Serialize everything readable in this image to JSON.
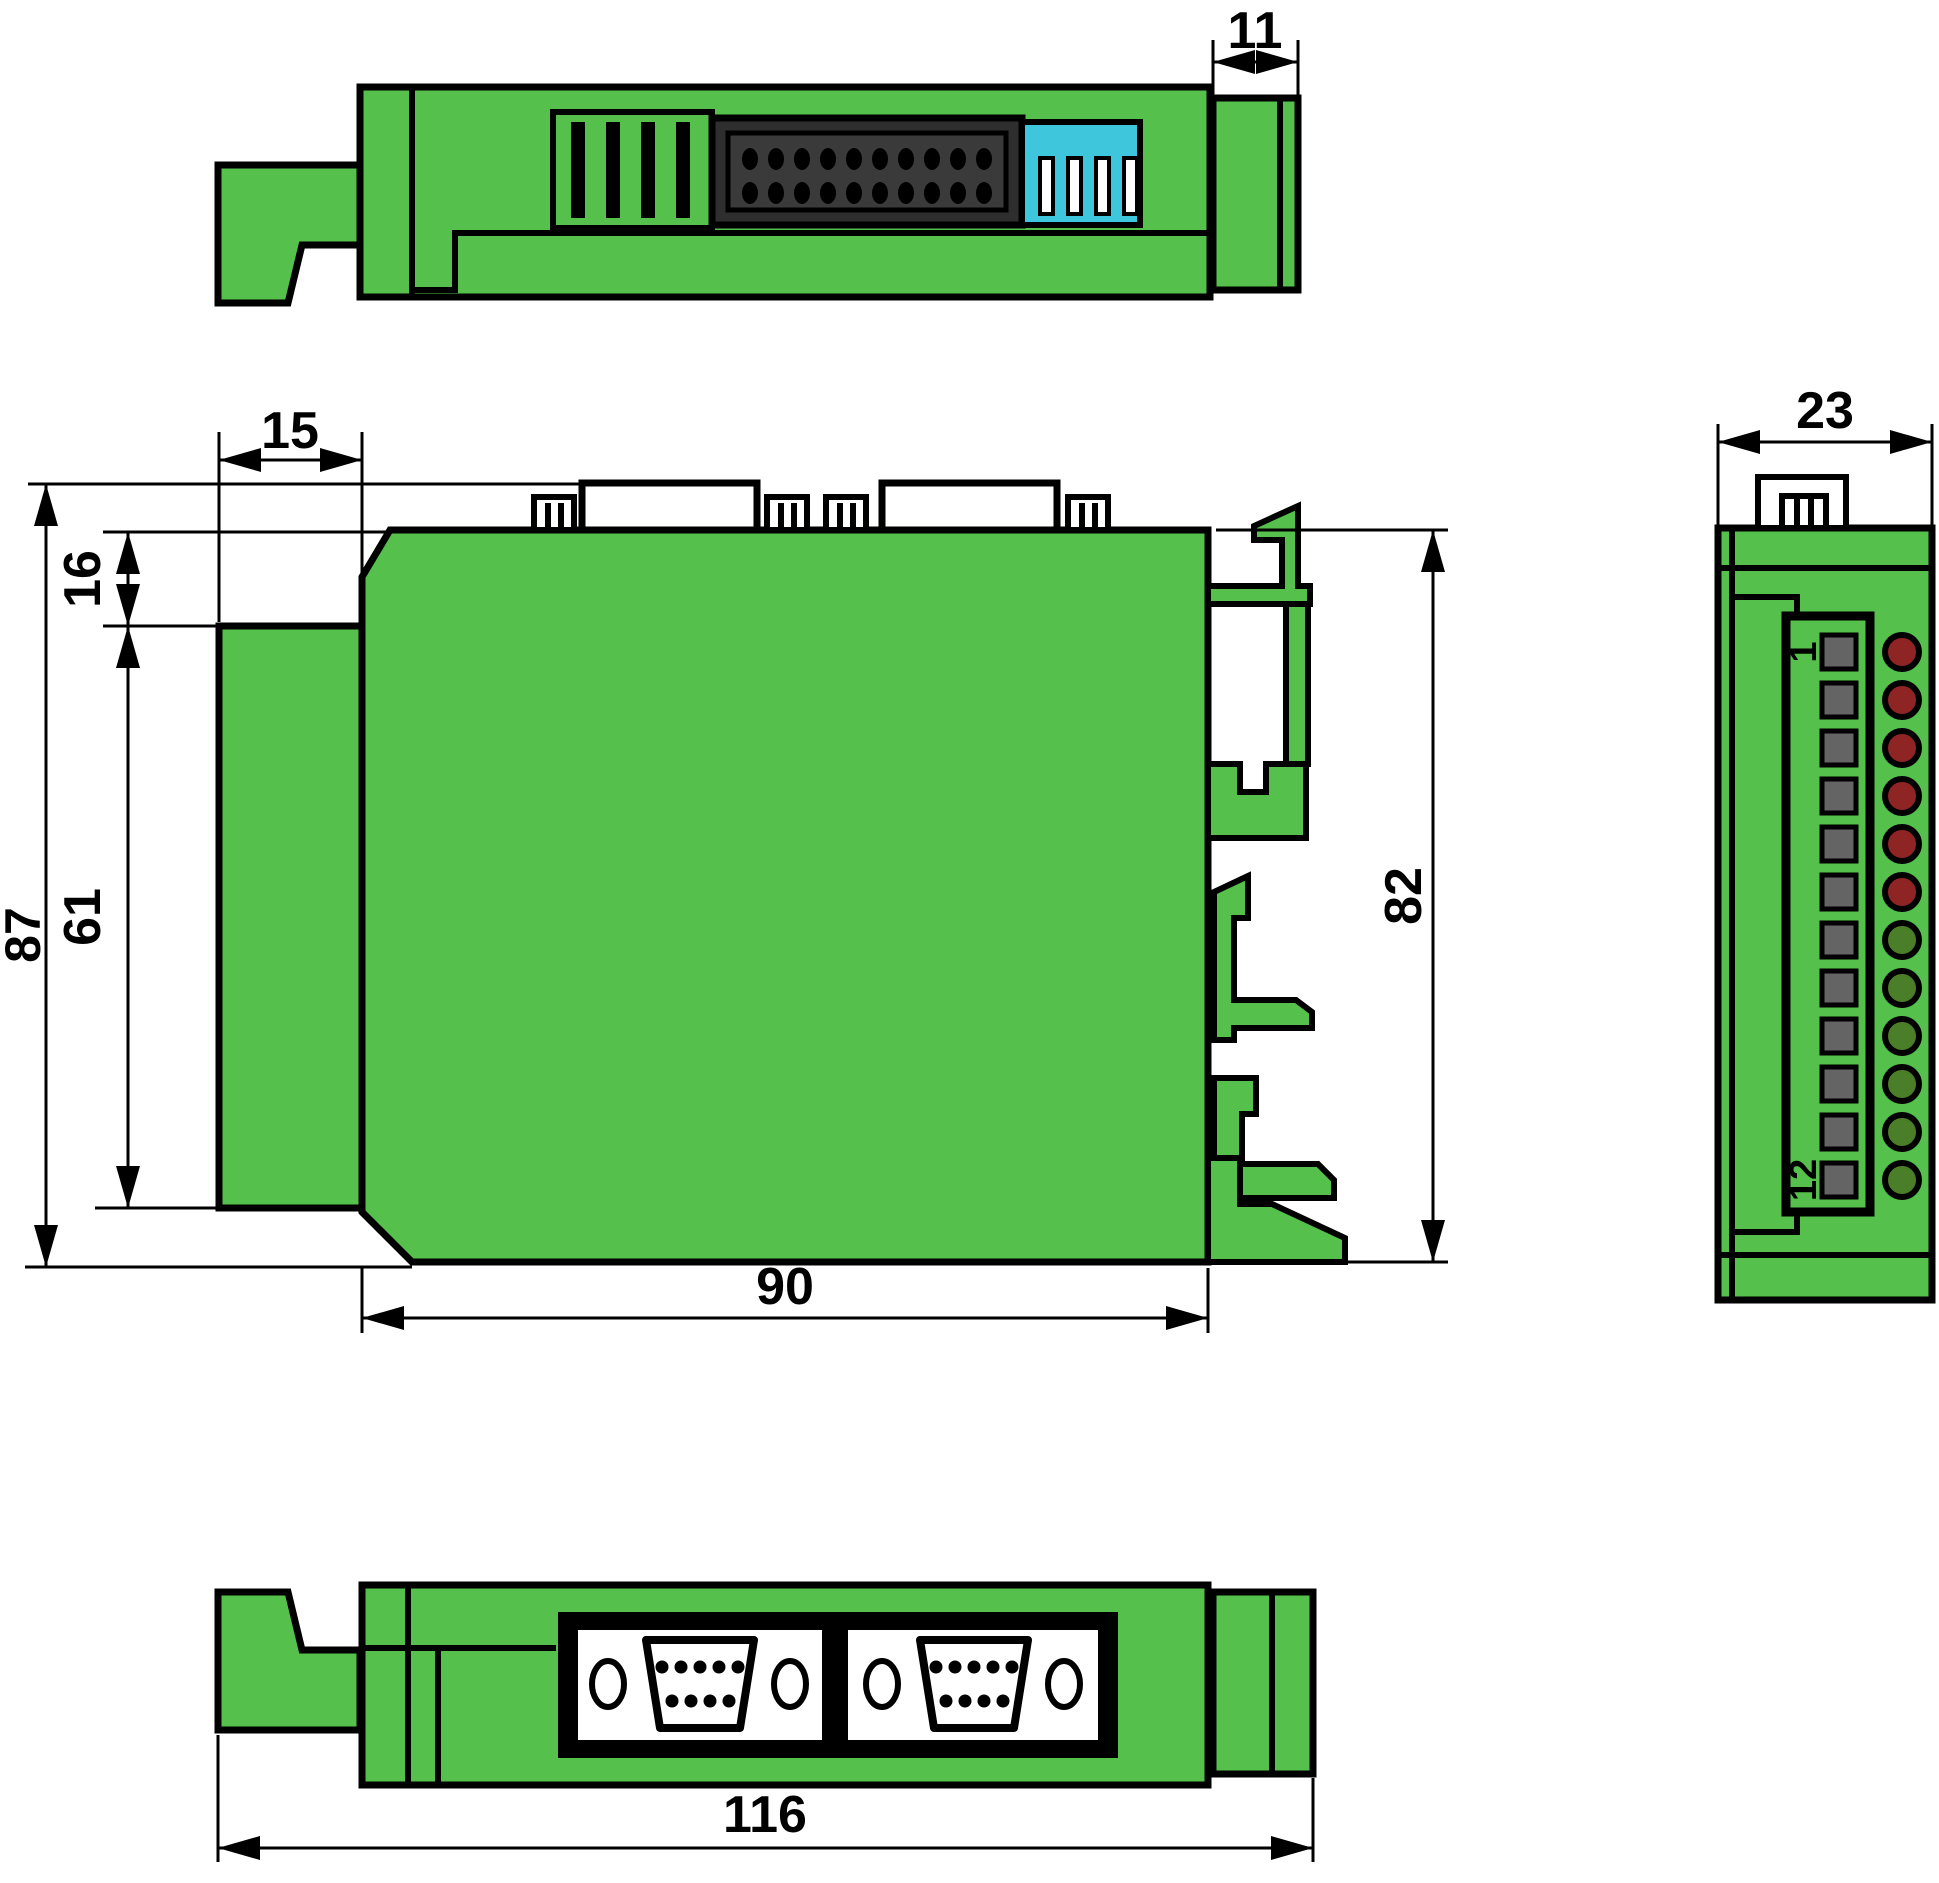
{
  "colors": {
    "body_green": "#55C14C",
    "outline": "#000000",
    "dip_switch_cyan": "#3EC6DC",
    "idc_body": "#2E2E2E",
    "idc_inner": "#3A3A3A",
    "terminal_gray": "#646464",
    "led_red": "#8E2423",
    "led_green": "#4A7E28",
    "background": "#FFFFFF"
  },
  "dims": {
    "d11": "11",
    "d15": "15",
    "d16": "16",
    "d61": "61",
    "d87": "87",
    "d90": "90",
    "d82": "82",
    "d23": "23",
    "d116": "116"
  },
  "top_view": {
    "vent_slats": 4,
    "idc_rows": 2,
    "idc_pins_per_row": 10,
    "dip_slots": 4
  },
  "front_view": {
    "terminal_count": 12,
    "terminal_first_label": "1",
    "terminal_last_label": "12",
    "led_count": 12,
    "led_states": [
      "red",
      "red",
      "red",
      "red",
      "red",
      "red",
      "green",
      "green",
      "green",
      "green",
      "green",
      "green"
    ]
  },
  "bottom_view": {
    "db9_count": 2,
    "db9_pins_top_row": 5,
    "db9_pins_bottom_row": 4
  }
}
